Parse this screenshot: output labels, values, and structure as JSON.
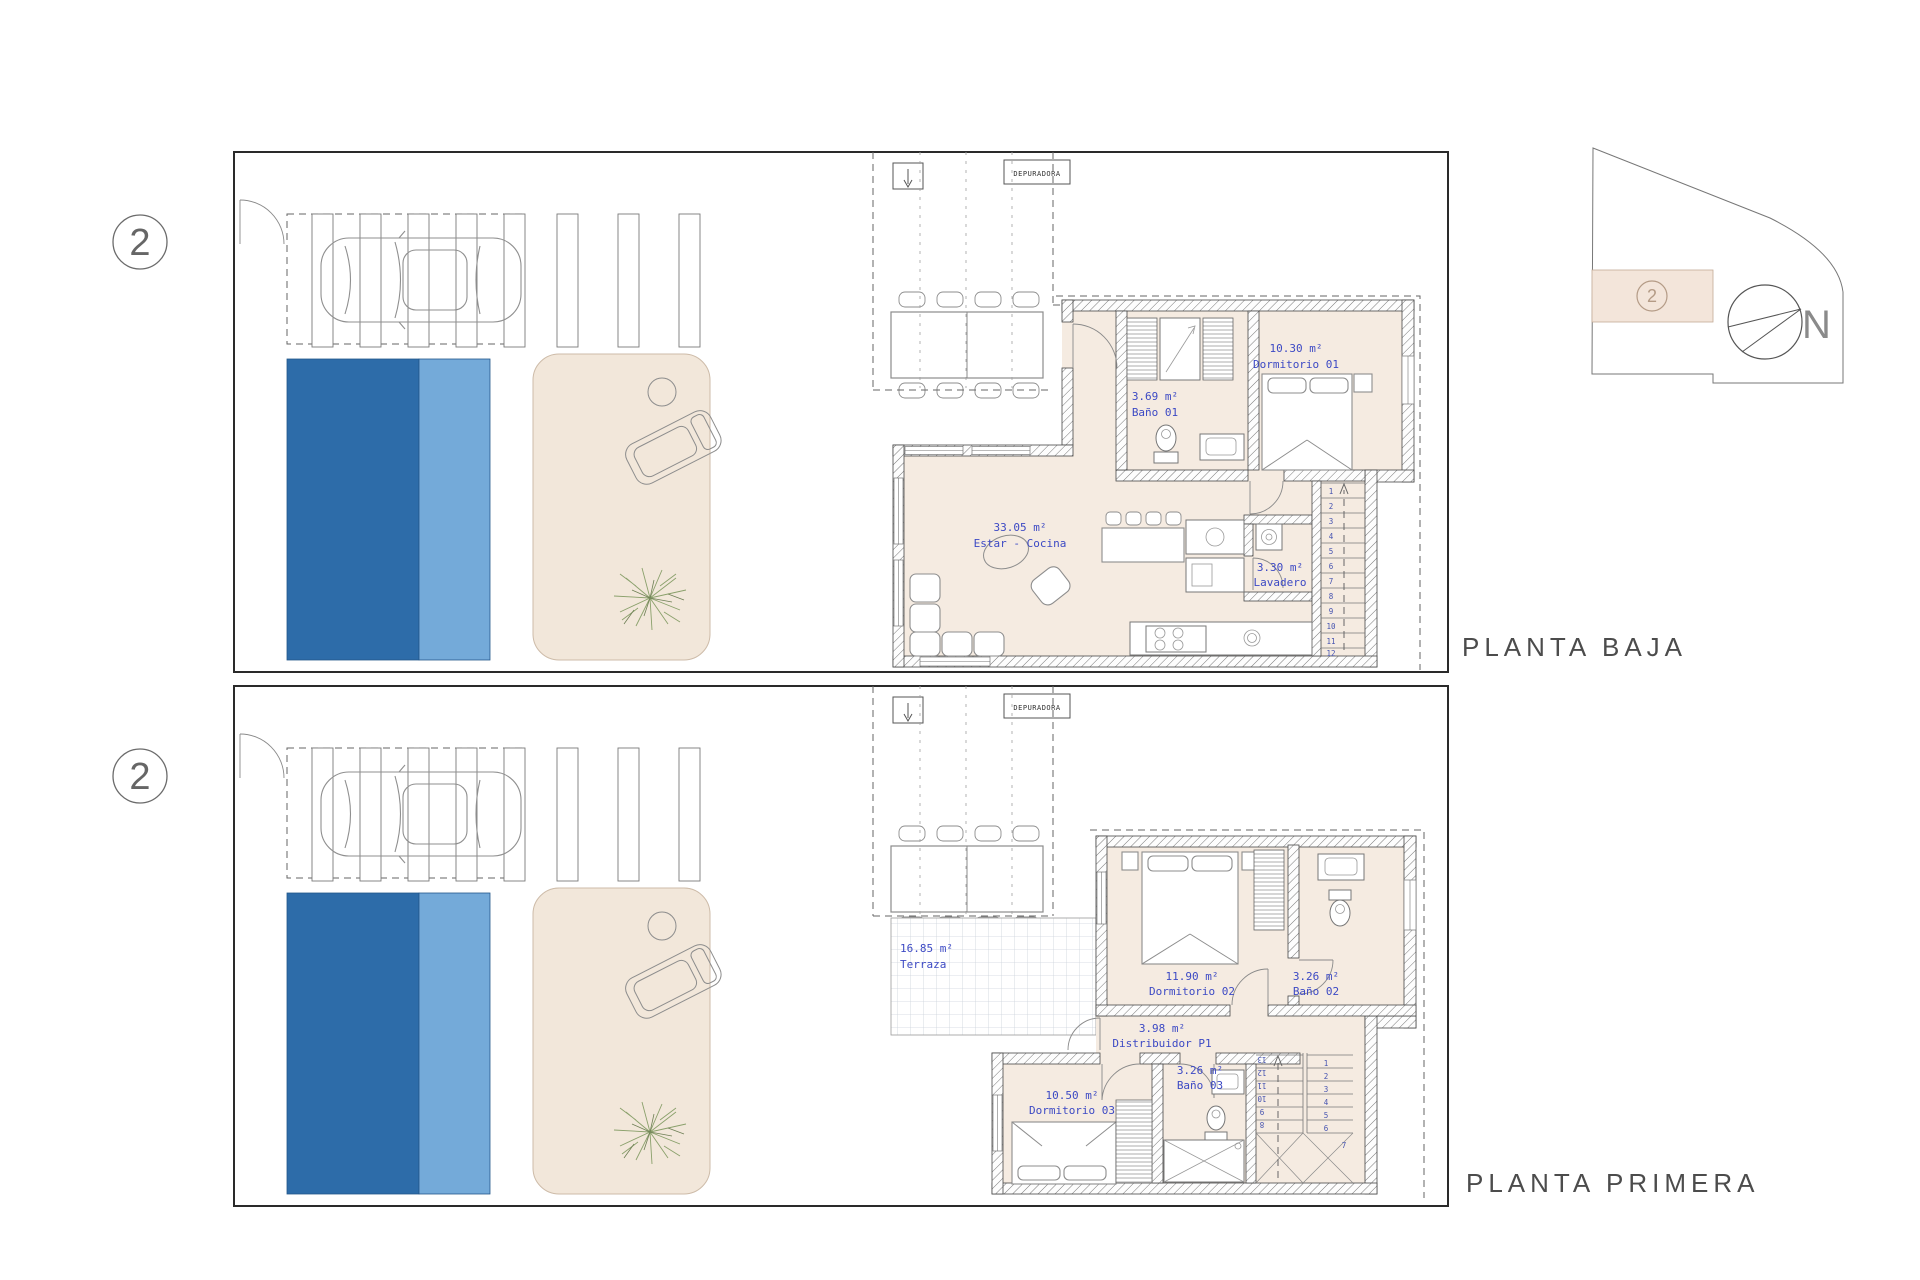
{
  "sheet": {
    "north_label": "N"
  },
  "key_plan": {
    "marker": "2",
    "north": "N"
  },
  "floors": {
    "baja": {
      "title": "PLANTA BAJA",
      "marker": "2",
      "equipment": "DEPURADORA",
      "rooms": {
        "dormitorio01": {
          "area": "10.30 m²",
          "name": "Dormitorio 01"
        },
        "bano01": {
          "area": "3.69 m²",
          "name": "Baño 01"
        },
        "estar": {
          "area": "33.05 m²",
          "name": "Estar - Cocina"
        },
        "lavadero": {
          "area": "3.30 m²",
          "name": "Lavadero"
        }
      },
      "stair_numbers": [
        "1",
        "2",
        "3",
        "4",
        "5",
        "6",
        "7",
        "8",
        "9",
        "10",
        "11",
        "12"
      ]
    },
    "primera": {
      "title": "PLANTA PRIMERA",
      "marker": "2",
      "equipment": "DEPURADORA",
      "rooms": {
        "terraza": {
          "area": "16.85 m²",
          "name": "Terraza"
        },
        "dormitorio02": {
          "area": "11.90 m²",
          "name": "Dormitorio 02"
        },
        "bano02": {
          "area": "3.26 m²",
          "name": "Baño 02"
        },
        "distribuidor": {
          "area": "3.98 m²",
          "name": "Distribuidor P1"
        },
        "bano03": {
          "area": "3.26 m²",
          "name": "Baño 03"
        },
        "dormitorio03": {
          "area": "10.50 m²",
          "name": "Dormitorio 03"
        }
      },
      "stairs_down": [
        "1",
        "2",
        "3",
        "4",
        "5",
        "6",
        "7"
      ],
      "stairs_up": [
        "8",
        "9",
        "10",
        "11",
        "12",
        "13"
      ]
    }
  },
  "colors": {
    "pool_deep": "#2d6ca9",
    "pool_shallow": "#74aad9",
    "floor_fill": "#f5ebe1",
    "patio_fill": "#f2e7da",
    "key_highlight": "#f3e5da",
    "label_blue": "#3c49c4"
  }
}
